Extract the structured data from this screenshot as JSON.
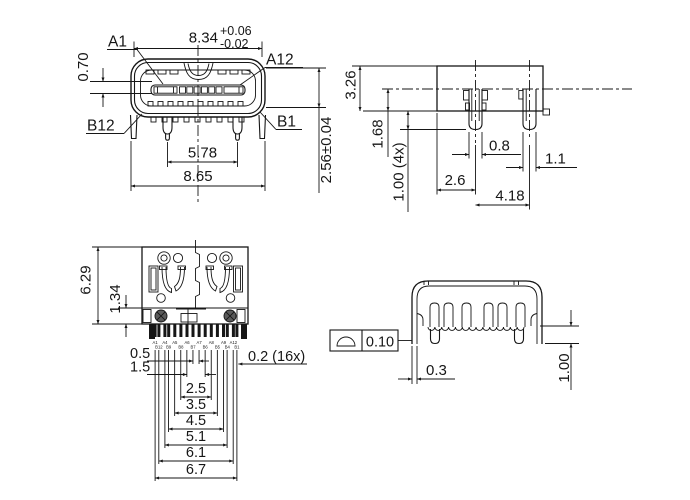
{
  "front_view": {
    "dim_shell_width": "8.34",
    "tol_plus": "+0.06",
    "tol_minus": "-0.02",
    "label_a1": "A1",
    "label_a12": "A12",
    "label_b12": "B12",
    "label_b1": "B1",
    "dim_tongue": "0.70",
    "dim_leg_pitch": "5.78",
    "dim_overall_width": "8.65",
    "dim_height": "2.56±0.04"
  },
  "side_view": {
    "dim_height": "3.26",
    "dim_center_height": "1.68",
    "dim_leg_protrusion": "1.00 (4x)",
    "dim_front_leg_width": "0.8",
    "dim_rear_leg_width": "1.1",
    "dim_front_to_leg": "2.6",
    "dim_leg_pitch": "4.18"
  },
  "top_view": {
    "dim_depth": "6.29",
    "dim_pin_zone": "1.34",
    "dim_pitches": [
      "0.5",
      "1.5",
      "2.5",
      "3.5",
      "4.5",
      "5.1",
      "6.1",
      "6.7"
    ],
    "dim_pin_width": "0.2 (16x)",
    "pin_labels_top": [
      "A1",
      "A4",
      "A5",
      "A6",
      "A7",
      "A8",
      "A9",
      "A12"
    ],
    "pin_labels_bottom": [
      "B12",
      "B9",
      "B8",
      "B7",
      "B6",
      "B5",
      "B4",
      "B1"
    ]
  },
  "rear_view": {
    "gdt_profile_tolerance": "0.10",
    "dim_shell_offset": "0.3",
    "dim_leg_height": "1.00"
  }
}
